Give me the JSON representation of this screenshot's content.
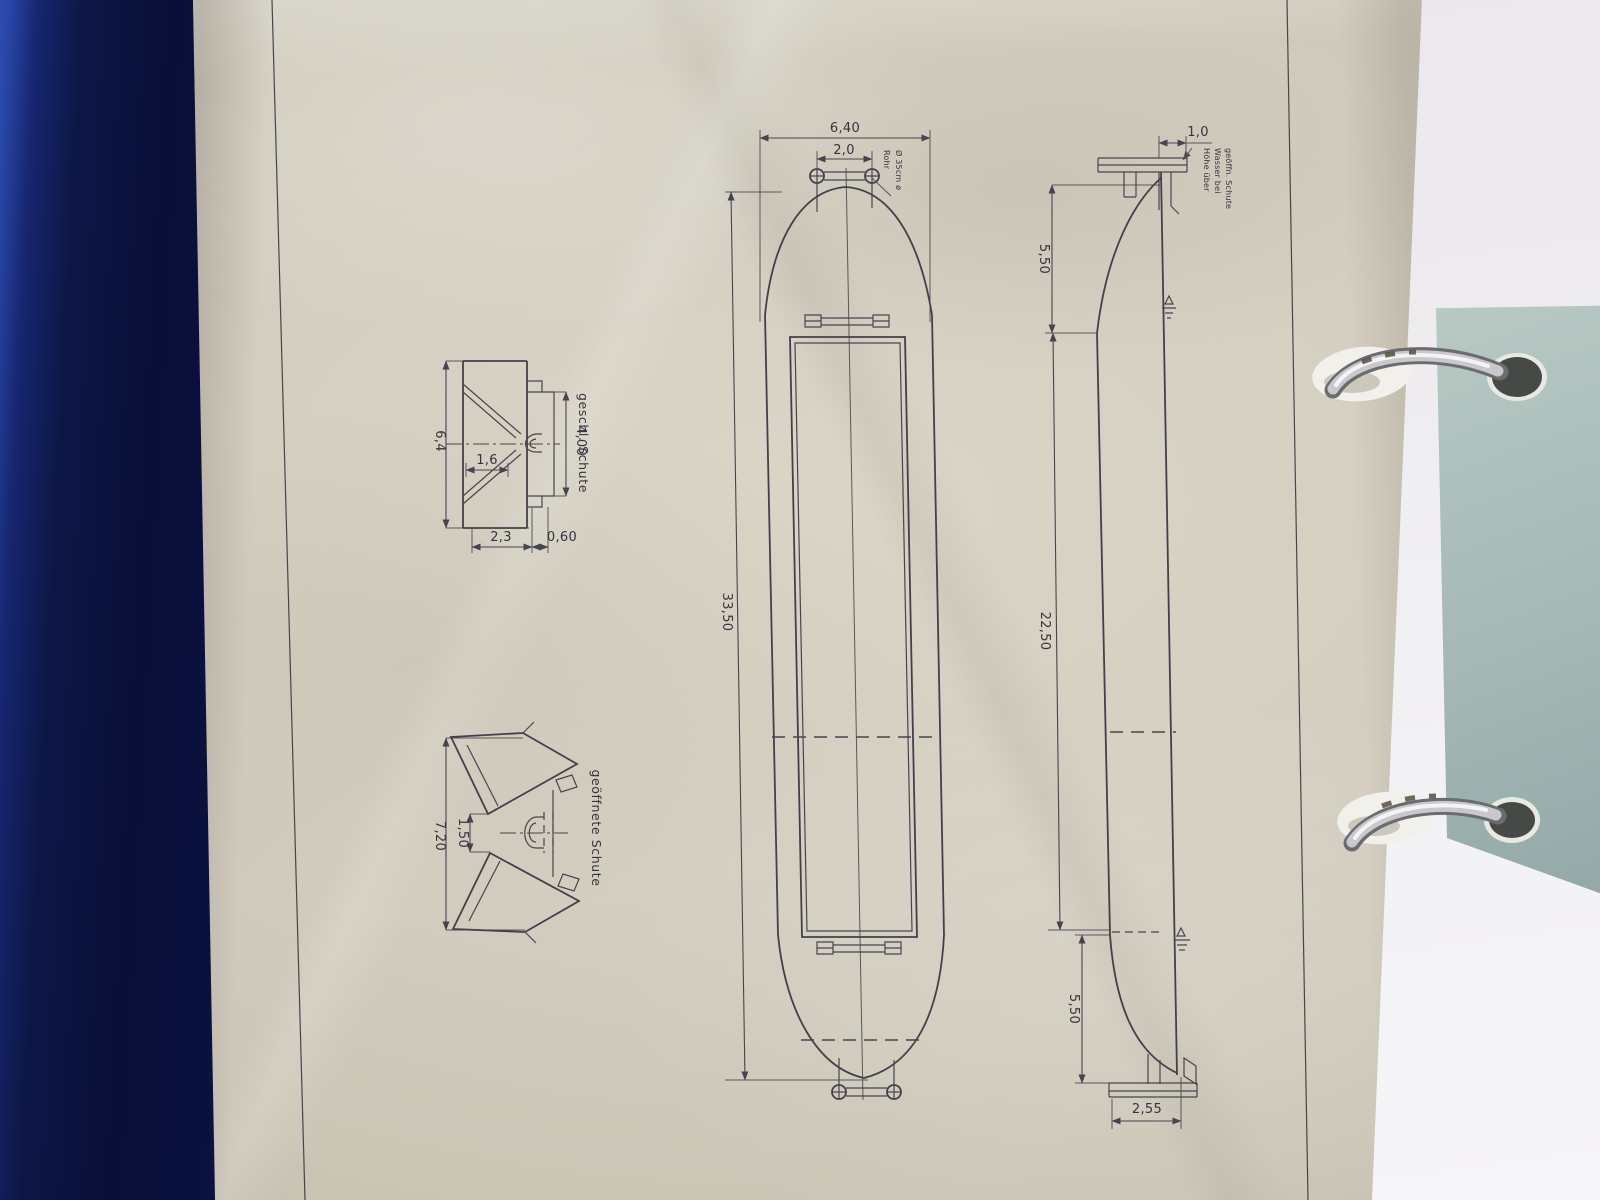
{
  "drawing": {
    "plan": {
      "beam": "6,40",
      "bollards": "2,0",
      "length": "33,50",
      "pipe1": "Rohr",
      "pipe2": "Ø 35cm ø"
    },
    "side": {
      "coaming": "1,0",
      "bow": "5,50",
      "parallel": "22,50",
      "stern": "5,50",
      "base": "2,55",
      "wl1": "Höhe über",
      "wl2": "Wasser bei",
      "wl3": "geöffn. Schute"
    },
    "closed": {
      "title": "geschl. Schute",
      "beam": "6,4",
      "trunk": "4,00",
      "gap": "1,6",
      "bottom": "2,3",
      "bilge": "0,60"
    },
    "open": {
      "title": "geöffnete Schute",
      "overall": "7,20",
      "gap": "1,50"
    }
  },
  "colors": {
    "ink": "#41414c",
    "paper_cream": "#d3cec0",
    "binder_blue": "#0d1747",
    "paper_sage": "#a9bcb8",
    "paper_white": "#efeef1",
    "ring_silver": "#c9c9cd"
  }
}
